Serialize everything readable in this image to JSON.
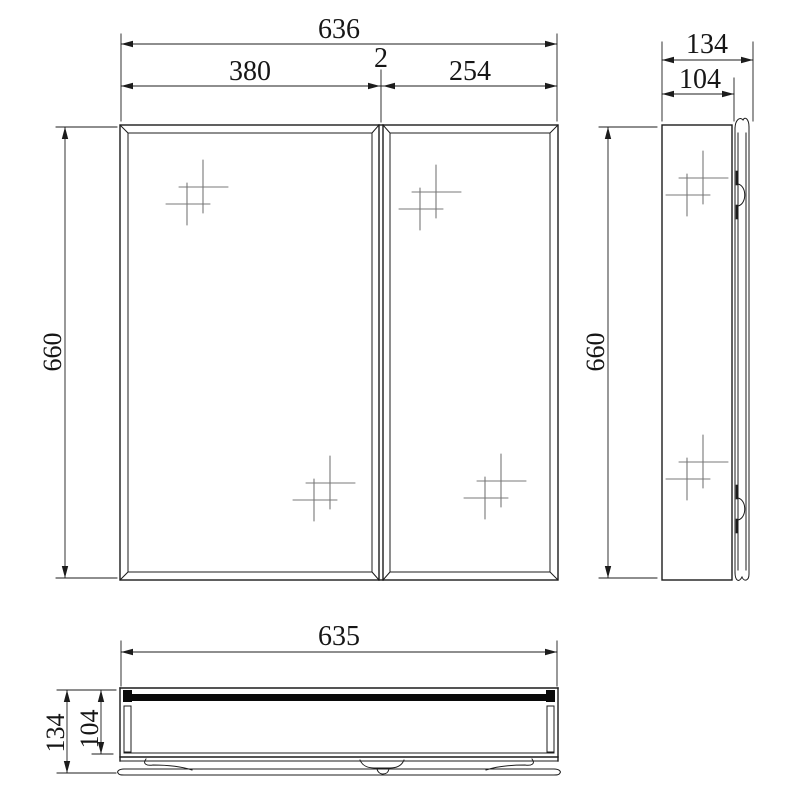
{
  "views": {
    "front": {
      "dim_overall_width": "636",
      "dim_left_door": "380",
      "dim_gap": "2",
      "dim_right_door": "254",
      "dim_height": "660"
    },
    "side": {
      "dim_overall_depth": "134",
      "dim_body_depth": "104",
      "dim_height": "660"
    },
    "bottom": {
      "dim_width": "635",
      "dim_overall_depth": "134",
      "dim_body_depth": "104"
    }
  },
  "icons": {
    "sparkle": "mirror-glint-sparkle"
  },
  "colors": {
    "line": "#1c1c1c",
    "background": "#ffffff",
    "mirror_bar": "#0a0a0a",
    "sparkle": "#787878"
  }
}
